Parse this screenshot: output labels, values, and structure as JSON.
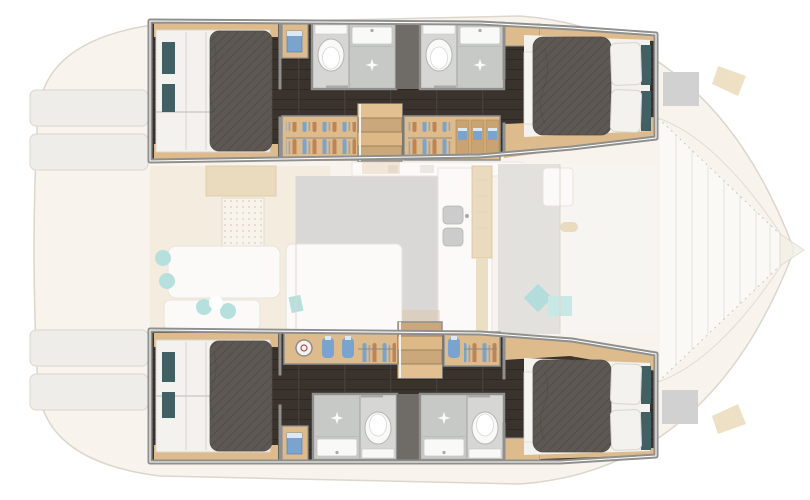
{
  "meta": {
    "title": "Catamaran yacht floor plan — lower deck highlighted (4-cabin / 4-shower-room version)",
    "canvas": {
      "width": 810,
      "height": 500
    },
    "visible_text": "",
    "highlight_note": "Hull accommodations rendered in full colour; main-deck areas shown ghosted/faded"
  },
  "palette": {
    "bg": "#ffffff",
    "wall": "#8f8f8d",
    "wall_dark": "#6f6b67",
    "floor_dark": "#3a332d",
    "floor_line": "#2e2823",
    "floor_joint": "#463f38",
    "wood": "#ddbb8d",
    "wood_dark": "#c9a371",
    "step": "#caa87b",
    "step_light": "#e2c092",
    "linen": "#f4f2ee",
    "linen_shadow": "#d9d6d1",
    "duvet": "#5d5853",
    "duvet_line": "#514c47",
    "teal": "#406064",
    "bath_floor": "#d6d6d4",
    "shower_floor": "#c7c9c7",
    "fixture": "#f9f9f7",
    "chrome": "#a9a9a7",
    "accent_blue": "#7aa4cd",
    "accent_blue_light": "#dce9f4",
    "accent_orange": "#c08353",
    "ghost_deck": "#f1e9da",
    "ghost_tan": "#e7d5b5",
    "ghost_gray": "#d4d2cf",
    "ghost_white": "#fbfaf8",
    "ghost_line": "#d6cfc3",
    "aqua": "#aadbd9",
    "hatch": "#c9c9c9"
  },
  "regions": {
    "boat": {
      "label": "Catamaran sailing yacht, top view floor plan"
    },
    "port_hull": {
      "label": "Port hull (top) — aft double cabin, two shower rooms, wardrobes, companionway steps, forward double cabin"
    },
    "starboard_hull": {
      "label": "Starboard hull (bottom) — aft double cabin, dressing units, companionway steps, two shower rooms, forward double cabin"
    },
    "main_deck": {
      "label": "Main deck shown faded: aft cockpit, saloon, galley, forward cockpit and bow trampoline"
    }
  },
  "rooms": {
    "aft_cabin": {
      "label": "Aft double cabin with island berth"
    },
    "fwd_cabin": {
      "label": "Forward double cabin with island berth"
    },
    "bathroom": {
      "label": "Shower room with WC, washbasin and shower"
    },
    "wardrobe": {
      "label": "Wardrobe with hanging clothes"
    },
    "drawers": {
      "label": "Locker with folded garments"
    },
    "vanity": {
      "label": "Dressing unit with accessories"
    },
    "stairs": {
      "label": "Companionway steps to saloon"
    },
    "cabinet": {
      "label": "Storage cabinet"
    },
    "cockpit": {
      "label": "Aft cockpit seating (faded)"
    },
    "saloon": {
      "label": "Saloon lounge (faded)"
    },
    "galley": {
      "label": "Galley with twin sinks (faded)"
    },
    "front_cockpit": {
      "label": "Forward cockpit seating (faded)"
    },
    "foredeck": {
      "label": "Bow trampoline and deck hatches (faded)"
    },
    "transom": {
      "label": "Transom swim platforms (faded)"
    }
  }
}
